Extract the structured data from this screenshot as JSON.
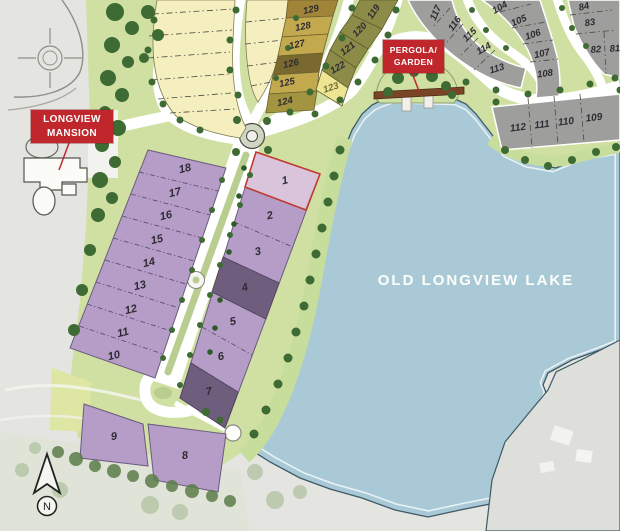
{
  "labels": {
    "mansion": {
      "line1": "LONGVIEW",
      "line2": "MANSION"
    },
    "pergola": {
      "line1": "PERGOLA/",
      "line2": "GARDEN"
    },
    "lake": "OLD LONGVIEW LAKE",
    "compass": "N"
  },
  "lots": {
    "purple_left": [
      "18",
      "17",
      "16",
      "15",
      "14",
      "13",
      "12",
      "11",
      "10"
    ],
    "purple_right": [
      "1",
      "2",
      "3",
      "4",
      "5",
      "6",
      "7"
    ],
    "purple_bottom": [
      "9",
      "8"
    ],
    "gold_column": [
      "129",
      "128",
      "127",
      "126",
      "125",
      "124"
    ],
    "olive_arc": [
      "119",
      "120",
      "121",
      "122",
      "123"
    ],
    "gray_arc_west": [
      "117",
      "116",
      "115",
      "114",
      "113"
    ],
    "gray_arc_east": [
      "104",
      "105",
      "106",
      "107",
      "108"
    ],
    "gray_column_right": [
      "84",
      "83",
      "82",
      "81"
    ],
    "gray_row_south": [
      "112",
      "111",
      "110",
      "109"
    ]
  },
  "colors": {
    "label_red": "#c0272d",
    "leader_red": "#c0272d",
    "lake_blue": "#a9c9d6",
    "shore_line": "#3d5a66",
    "purple": "#b59dc7",
    "purple_dark": "#6f5d7d",
    "purple_light": "#d9c4dc",
    "lot1_outline": "#c03a30",
    "cream": "#f5efbf",
    "gold": "#c3a94e",
    "tan": "#a08538",
    "gold_olive": "#a3953f",
    "olive_dark": "#79692f",
    "olive": "#8c8c48",
    "pale_yellow": "#efe492",
    "gray_lot": "#9e9e9c",
    "green": "#cfe0a2",
    "green_band": "#c6dd9b",
    "tree": "#3e6b33",
    "median_green": "#b9cd90",
    "road_white": "#ffffff"
  }
}
